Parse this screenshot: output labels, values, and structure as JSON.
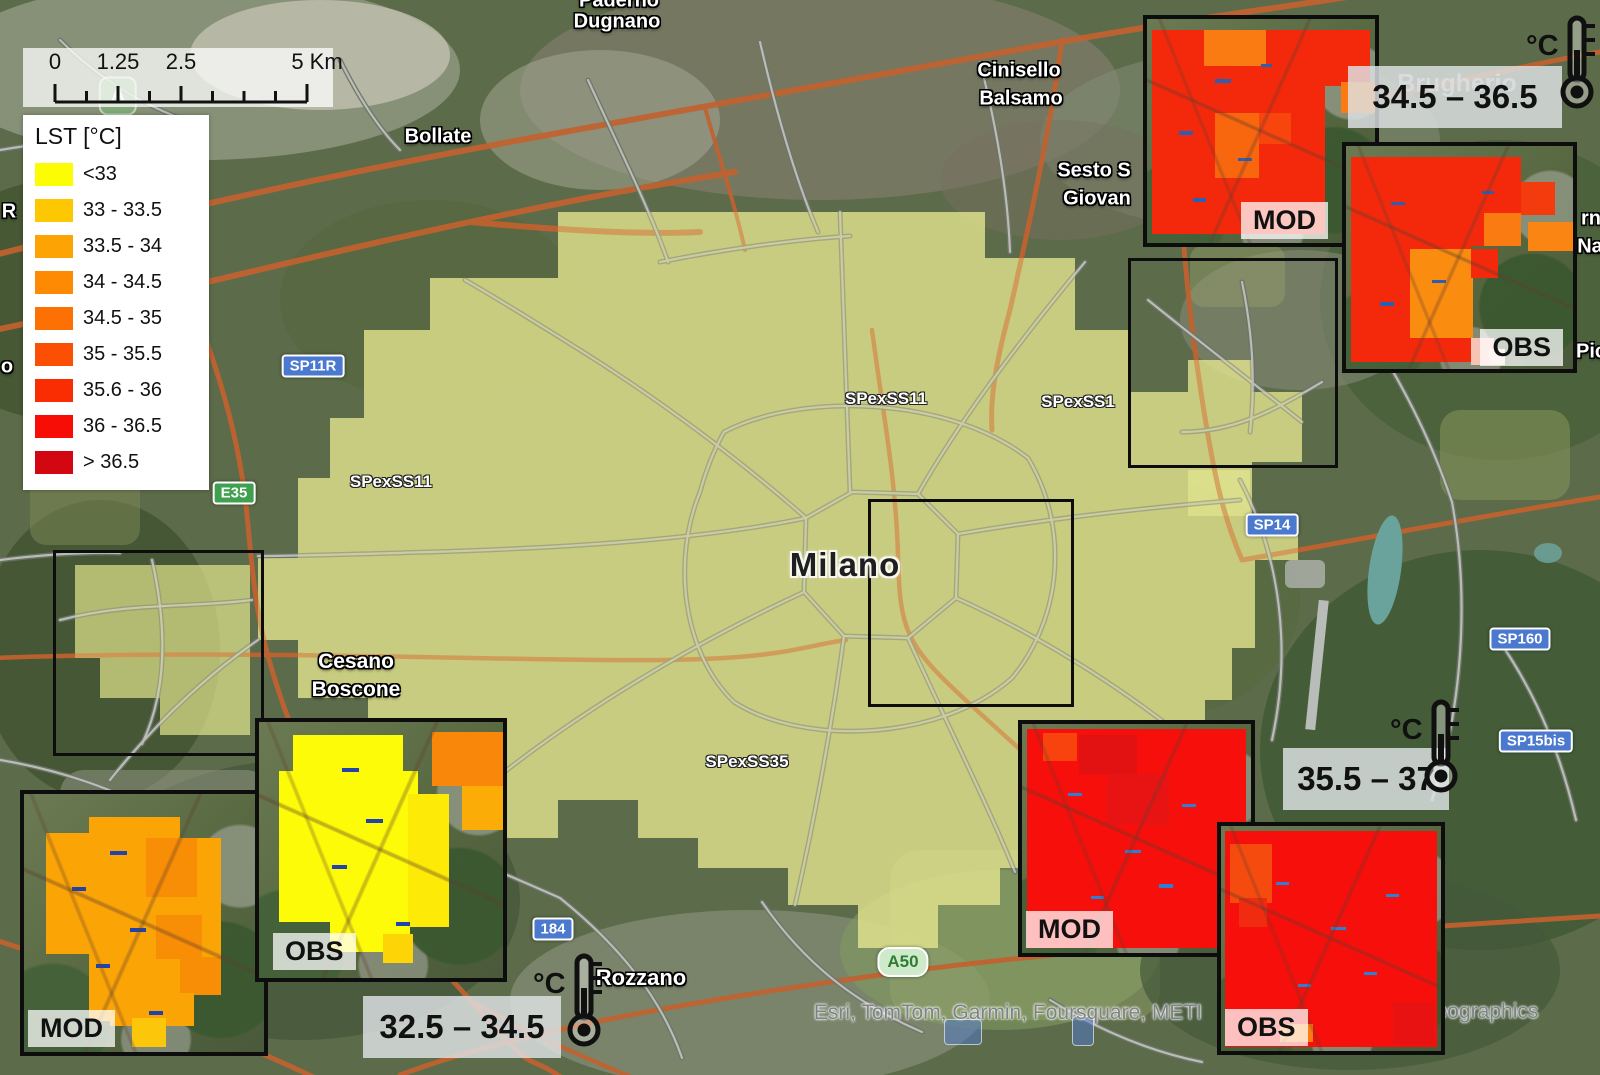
{
  "legend": {
    "title": "LST [°C]",
    "items": [
      {
        "label": "<33",
        "color": "#FCFC02"
      },
      {
        "label": "33 - 33.5",
        "color": "#FDC701"
      },
      {
        "label": "33.5 - 34",
        "color": "#FDA303"
      },
      {
        "label": "34 - 34.5",
        "color": "#FD8A02"
      },
      {
        "label": "34.5 - 35",
        "color": "#FC7004"
      },
      {
        "label": "35 - 35.5",
        "color": "#FB5003"
      },
      {
        "label": "35.6 - 36",
        "color": "#FA2D02"
      },
      {
        "label": "36 - 36.5",
        "color": "#F70D06"
      },
      {
        "label": "> 36.5",
        "color": "#D20711"
      }
    ]
  },
  "scalebar": {
    "labels": [
      {
        "t": "0",
        "x": 32
      },
      {
        "t": "1.25",
        "x": 95
      },
      {
        "t": "2.5",
        "x": 158
      },
      {
        "t": "5 Km",
        "x": 294
      }
    ]
  },
  "temp_tags": [
    {
      "value": "34.5 – 36.5",
      "unit": "°C",
      "box": {
        "x": 1348,
        "y": 66,
        "w": 214,
        "h": 62
      },
      "thermo": {
        "x": 1526,
        "y": 14
      }
    },
    {
      "value": "35.5 – 37",
      "unit": "°C",
      "box": {
        "x": 1283,
        "y": 748,
        "w": 166,
        "h": 62
      },
      "thermo": {
        "x": 1390,
        "y": 698
      }
    },
    {
      "value": "32.5 – 34.5",
      "unit": "°C",
      "box": {
        "x": 363,
        "y": 996,
        "w": 198,
        "h": 62
      },
      "thermo": {
        "x": 533,
        "y": 952
      }
    }
  ],
  "insets": [
    {
      "id": "ne-mod",
      "label": "MOD",
      "x": 1143,
      "y": 15,
      "w": 236,
      "h": 232,
      "chip": {
        "side": "right",
        "dx": 47,
        "dy": 4
      },
      "cells": [
        [
          2,
          5,
          76,
          91,
          "#f4290c"
        ],
        [
          25,
          5,
          27,
          16,
          "#fa7b11"
        ],
        [
          78,
          5,
          20,
          25,
          "#f4290c"
        ],
        [
          85,
          28,
          15,
          14,
          "#fa7b11"
        ],
        [
          30,
          42,
          19,
          29,
          "#f8660e"
        ],
        [
          49,
          42,
          14,
          14,
          "#f8440d"
        ],
        [
          30,
          27,
          7,
          1.6,
          "#2d5fb0"
        ],
        [
          14,
          50,
          6,
          1.6,
          "#2d5fb0"
        ],
        [
          50,
          20,
          5,
          1.6,
          "#2d5fb0"
        ],
        [
          40,
          62,
          6,
          1.6,
          "#2d5fb0"
        ],
        [
          20,
          80,
          6,
          1.6,
          "#2d5fb0"
        ]
      ]
    },
    {
      "id": "ne-obs",
      "label": "OBS",
      "x": 1342,
      "y": 142,
      "w": 235,
      "h": 231,
      "chip": {
        "side": "right",
        "dx": 10,
        "dy": 3
      },
      "cells": [
        [
          2,
          5,
          53,
          92,
          "#f4290c"
        ],
        [
          55,
          5,
          22,
          40,
          "#f4290c"
        ],
        [
          77,
          16,
          15,
          15,
          "#f43b0d"
        ],
        [
          61,
          30,
          16,
          15,
          "#fa7b11"
        ],
        [
          80,
          34,
          20,
          13,
          "#fa8513"
        ],
        [
          28,
          46,
          28,
          40,
          "#fa8c10"
        ],
        [
          55,
          46,
          12,
          13,
          "#f4290c"
        ],
        [
          55,
          86,
          10,
          12,
          "#f6c4b4"
        ],
        [
          63,
          91,
          7,
          7,
          "#f8d9cb"
        ],
        [
          20,
          25,
          6,
          1.6,
          "#2d5fb0"
        ],
        [
          38,
          60,
          6,
          1.6,
          "#2d5fb0"
        ],
        [
          15,
          70,
          6,
          1.6,
          "#2d5fb0"
        ],
        [
          60,
          20,
          5,
          1.6,
          "#2d5fb0"
        ]
      ]
    },
    {
      "id": "w-mod",
      "label": "MOD",
      "x": 20,
      "y": 790,
      "w": 248,
      "h": 266,
      "chip": {
        "side": "left",
        "dx": 4,
        "dy": 5
      },
      "cells": [
        [
          27,
          9,
          38,
          79,
          "#fba406"
        ],
        [
          9,
          15,
          26,
          47,
          "#fba406"
        ],
        [
          51,
          17,
          31,
          61,
          "#fba406"
        ],
        [
          51,
          17,
          21,
          23,
          "#f88d06"
        ],
        [
          55,
          47,
          19,
          17,
          "#f88d06"
        ],
        [
          65,
          63,
          17,
          15,
          "#f88d06"
        ],
        [
          36,
          77,
          35,
          13,
          "#fba406"
        ],
        [
          45,
          87,
          14,
          11,
          "#fcc60b"
        ],
        [
          36,
          22,
          7,
          1.6,
          "#2244aa"
        ],
        [
          20,
          36,
          6,
          1.5,
          "#2244aa"
        ],
        [
          44,
          52,
          7,
          1.5,
          "#2244aa"
        ],
        [
          30,
          66,
          6,
          1.5,
          "#2244aa"
        ],
        [
          52,
          84,
          6,
          1.5,
          "#2244aa"
        ]
      ]
    },
    {
      "id": "w-obs",
      "label": "OBS",
      "x": 255,
      "y": 718,
      "w": 252,
      "h": 264,
      "chip": {
        "side": "left",
        "dx": 14,
        "dy": 8
      },
      "cells": [
        [
          14,
          5,
          45,
          17,
          "#fdfb08"
        ],
        [
          8,
          19,
          57,
          59,
          "#fdfb08"
        ],
        [
          29,
          74,
          33,
          16,
          "#fdfb08"
        ],
        [
          61,
          28,
          17,
          52,
          "#fdea06"
        ],
        [
          71,
          4,
          29,
          21,
          "#f8870a"
        ],
        [
          83,
          25,
          17,
          17,
          "#fbac06"
        ],
        [
          51,
          83,
          12,
          11,
          "#fdd506"
        ],
        [
          34,
          18,
          7,
          1.5,
          "#2244aa"
        ],
        [
          44,
          38,
          7,
          1.5,
          "#2244aa"
        ],
        [
          30,
          56,
          6,
          1.5,
          "#2244aa"
        ],
        [
          56,
          78,
          6,
          1.5,
          "#2244aa"
        ]
      ]
    },
    {
      "id": "se-mod",
      "label": "MOD",
      "x": 1018,
      "y": 720,
      "w": 237,
      "h": 237,
      "chip": {
        "side": "left",
        "dx": 4,
        "dy": 5
      },
      "cells": [
        [
          2,
          2,
          96,
          96,
          "#f60f0b"
        ],
        [
          25,
          5,
          25,
          17,
          "#e31212"
        ],
        [
          37,
          22,
          27,
          22,
          "#e81414"
        ],
        [
          9,
          4,
          15,
          12,
          "#f8430e"
        ],
        [
          20,
          30,
          6,
          1.4,
          "#2d7fd4"
        ],
        [
          45,
          55,
          7,
          1.4,
          "#2d7fd4"
        ],
        [
          60,
          70,
          6,
          1.4,
          "#2d7fd4"
        ],
        [
          30,
          75,
          6,
          1.4,
          "#2d7fd4"
        ],
        [
          70,
          35,
          6,
          1.4,
          "#2d7fd4"
        ]
      ]
    },
    {
      "id": "se-obs",
      "label": "OBS",
      "x": 1217,
      "y": 822,
      "w": 228,
      "h": 233,
      "chip": {
        "side": "left",
        "dx": 4,
        "dy": 5
      },
      "cells": [
        [
          2,
          2,
          96,
          96,
          "#f60f0b"
        ],
        [
          4,
          8,
          19,
          26,
          "#f54b0e"
        ],
        [
          8,
          32,
          13,
          13,
          "#f12b10"
        ],
        [
          27,
          88,
          15,
          8,
          "#fa7b10"
        ],
        [
          78,
          78,
          19,
          19,
          "#e91212"
        ],
        [
          25,
          25,
          6,
          1.4,
          "#2d7fd4"
        ],
        [
          50,
          45,
          7,
          1.4,
          "#2d7fd4"
        ],
        [
          65,
          65,
          6,
          1.4,
          "#2d7fd4"
        ],
        [
          35,
          70,
          6,
          1.4,
          "#2d7fd4"
        ],
        [
          75,
          30,
          6,
          1.4,
          "#2d7fd4"
        ]
      ]
    }
  ],
  "study_boxes": [
    {
      "x": 53,
      "y": 550,
      "w": 205,
      "h": 200
    },
    {
      "x": 868,
      "y": 499,
      "w": 200,
      "h": 202
    },
    {
      "x": 1128,
      "y": 258,
      "w": 204,
      "h": 204
    }
  ],
  "cities": [
    {
      "t": "Paderno",
      "x": 619,
      "y": 1,
      "fs": 20
    },
    {
      "t": "Dugnano",
      "x": 617,
      "y": 22,
      "fs": 20
    },
    {
      "t": "Bollate",
      "x": 438,
      "y": 137,
      "fs": 20
    },
    {
      "t": "Cinisello",
      "x": 1019,
      "y": 71,
      "fs": 20
    },
    {
      "t": "Balsamo",
      "x": 1021,
      "y": 99,
      "fs": 20
    },
    {
      "t": "Sesto S",
      "x": 1094,
      "y": 171,
      "fs": 20
    },
    {
      "t": "Giovan",
      "x": 1097,
      "y": 199,
      "fs": 20
    },
    {
      "t": "Milano",
      "x": 845,
      "y": 565,
      "fs": 33,
      "cls": "major"
    },
    {
      "t": "Cesano",
      "x": 356,
      "y": 662,
      "fs": 21
    },
    {
      "t": "Boscone",
      "x": 356,
      "y": 690,
      "fs": 21
    },
    {
      "t": "Rozzano",
      "x": 641,
      "y": 978,
      "fs": 22
    },
    {
      "t": "Brugherio",
      "x": 1457,
      "y": 84,
      "fs": 25,
      "cls": "ghost"
    },
    {
      "t": "R",
      "x": 9,
      "y": 212,
      "fs": 20
    },
    {
      "t": "o",
      "x": 7,
      "y": 367,
      "fs": 20
    },
    {
      "t": "rn",
      "x": 1591,
      "y": 219,
      "fs": 20
    },
    {
      "t": "Na",
      "x": 1590,
      "y": 247,
      "fs": 20
    },
    {
      "t": "Pic",
      "x": 1591,
      "y": 352,
      "fs": 20
    }
  ],
  "road_labels": [
    {
      "t": "SPexSS11",
      "x": 886,
      "y": 399
    },
    {
      "t": "SPexSS1",
      "x": 1078,
      "y": 402
    },
    {
      "t": "SPexSS11",
      "x": 391,
      "y": 482
    },
    {
      "t": "SPexSS35",
      "x": 747,
      "y": 762
    }
  ],
  "shields": [
    {
      "t": "SP11R",
      "x": 313,
      "y": 366,
      "type": "blue"
    },
    {
      "t": "SP14",
      "x": 1272,
      "y": 525,
      "type": "blue"
    },
    {
      "t": "SP160",
      "x": 1520,
      "y": 639,
      "type": "blue"
    },
    {
      "t": "SP15bis",
      "x": 1536,
      "y": 741,
      "type": "blue"
    },
    {
      "t": "184",
      "x": 553,
      "y": 929,
      "type": "blue"
    },
    {
      "t": "E35",
      "x": 234,
      "y": 493,
      "type": "green"
    },
    {
      "t": "A50",
      "x": 903,
      "y": 962,
      "type": "lightgreen"
    },
    {
      "t": "A",
      "x": 118,
      "y": 96,
      "type": "ghostgreen"
    },
    {
      "t": "",
      "x": 963,
      "y": 1032,
      "type": "bluefaded",
      "w": 36,
      "h": 24
    },
    {
      "t": "",
      "x": 1083,
      "y": 1031,
      "type": "bluefaded",
      "w": 20,
      "h": 28
    }
  ],
  "attribution": {
    "left": "Esri, TomTom, Garmin, Foursquare, METI",
    "right": "eographics",
    "left_x": 1008,
    "left_y": 1013,
    "right_x": 1487,
    "right_y": 1012
  },
  "colors": {
    "lst_overlay": "#e3e58f",
    "shield_blue": "#4a79cf",
    "shield_green": "#3fa14f",
    "motorway_orange": "#c2622f",
    "road_gray": "#b9bdb4"
  }
}
